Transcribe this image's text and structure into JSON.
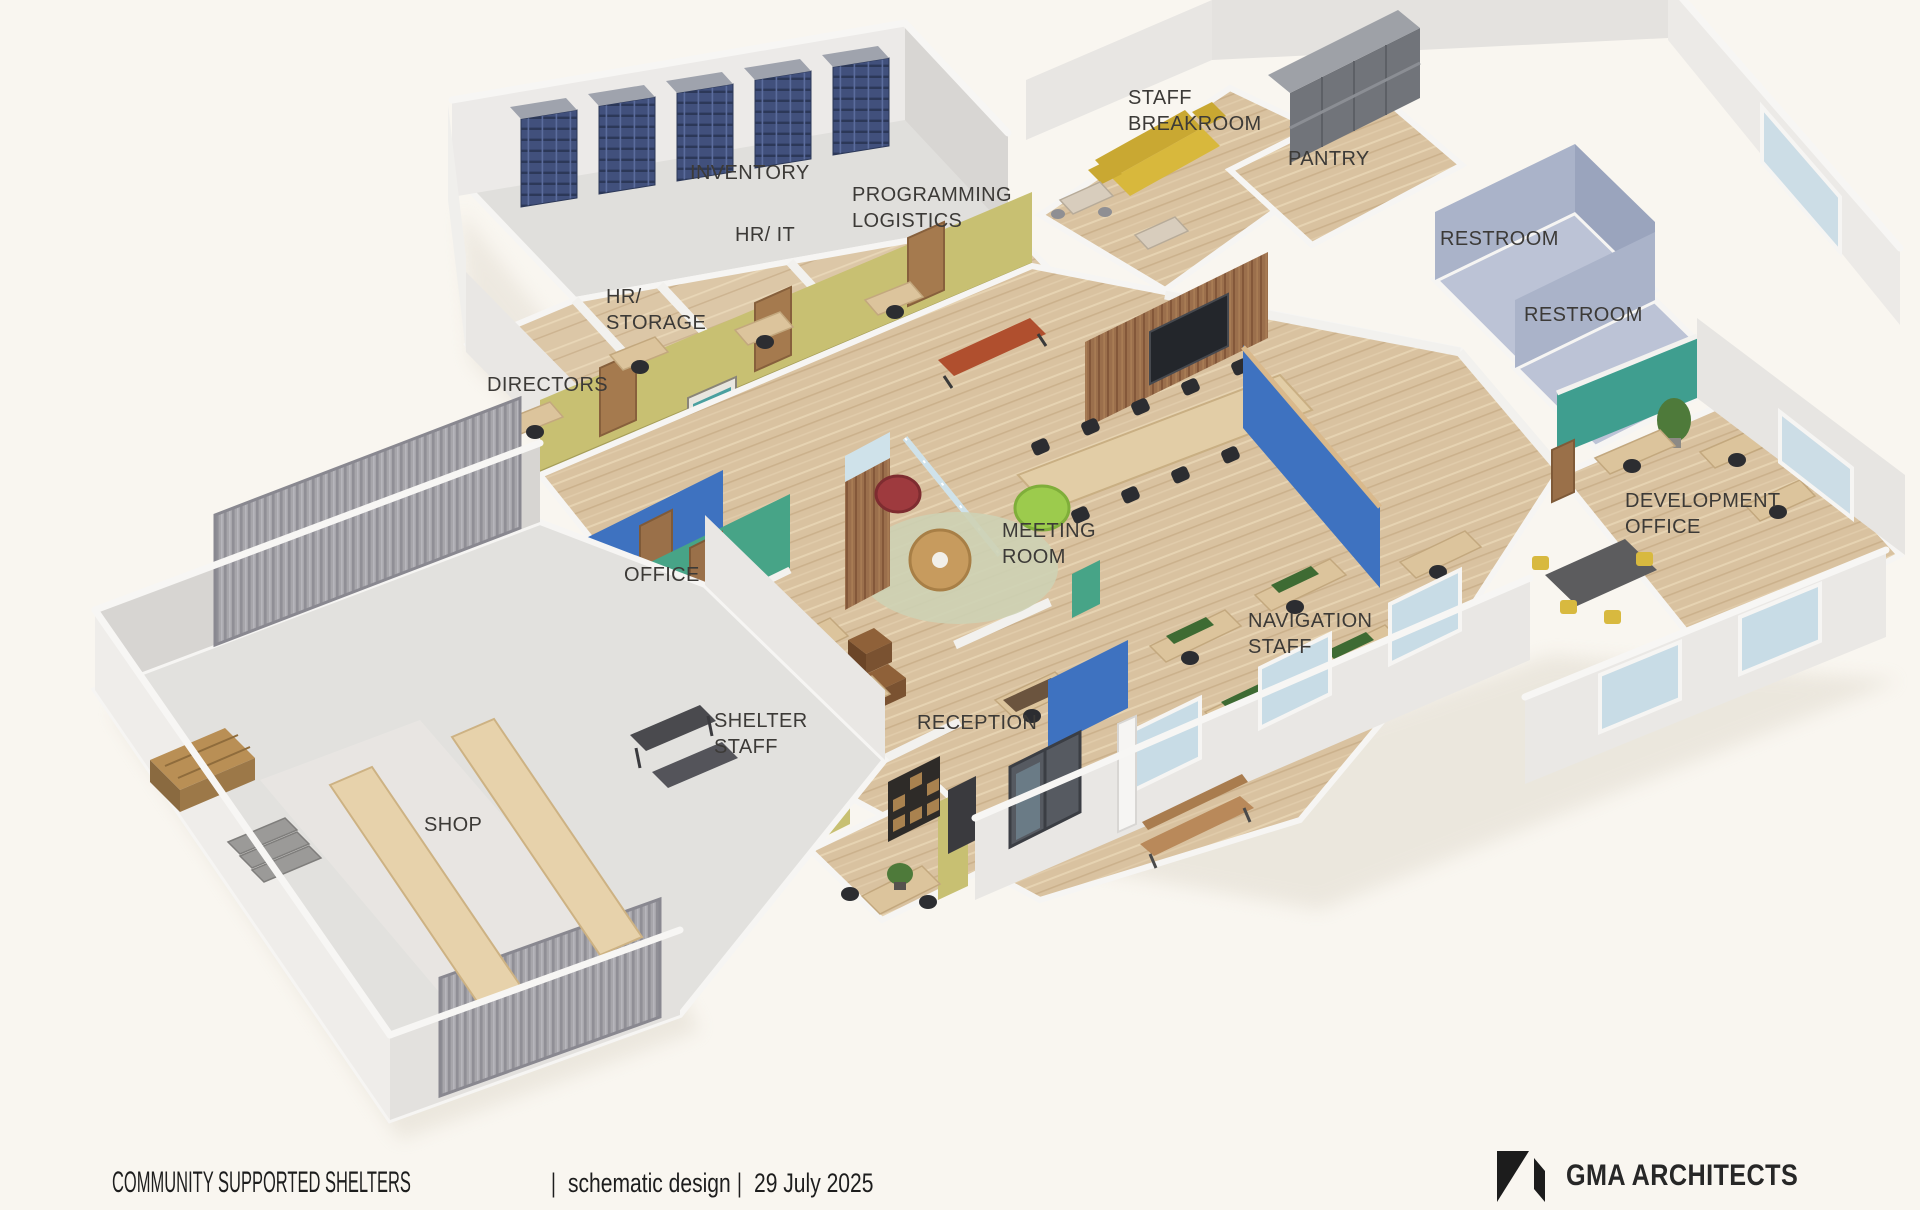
{
  "rooms": [
    {
      "label": "INVENTORY"
    },
    {
      "label": "HR/ IT"
    },
    {
      "label": "PROGRAMMING\nLOGISTICS"
    },
    {
      "label": "HR/\nSTORAGE"
    },
    {
      "label": "DIRECTORS"
    },
    {
      "label": "STAFF\nBREAKROOM"
    },
    {
      "label": "PANTRY"
    },
    {
      "label": "RESTROOM"
    },
    {
      "label": "RESTROOM"
    },
    {
      "label": "MEETING\nROOM"
    },
    {
      "label": "OFFICE"
    },
    {
      "label": "SHELTER\nSTAFF"
    },
    {
      "label": "RECEPTION"
    },
    {
      "label": "NAVIGATION\nSTAFF"
    },
    {
      "label": "DEVELOPMENT\nOFFICE"
    },
    {
      "label": "SHOP"
    }
  ],
  "titleblock": {
    "project": "COMMUNITY SUPPORTED SHELTERS",
    "phase": "schematic design",
    "date": "29 July 2025",
    "separator": "|"
  },
  "brand": {
    "name": "GMA ARCHITECTS",
    "logo_icon": "gma-logo-mark"
  },
  "palette": {
    "background": "#f9f6f0",
    "wall_white": "#eceae7",
    "wall_olive": "#c8c072",
    "wall_blue": "#3e72c0",
    "wall_green": "#47a487",
    "wall_teal": "#3f9e8f",
    "restroom_blue": "#aab3c9",
    "floor_wood": "#d9c2a0",
    "floor_concrete": "#e2e1de",
    "sofa_yellow": "#d8b83c",
    "ottoman_purple": "#5636a8",
    "door_wood": "#a57a4e",
    "chair_black": "#2c2d31",
    "logo_black": "#1c1c1c"
  }
}
